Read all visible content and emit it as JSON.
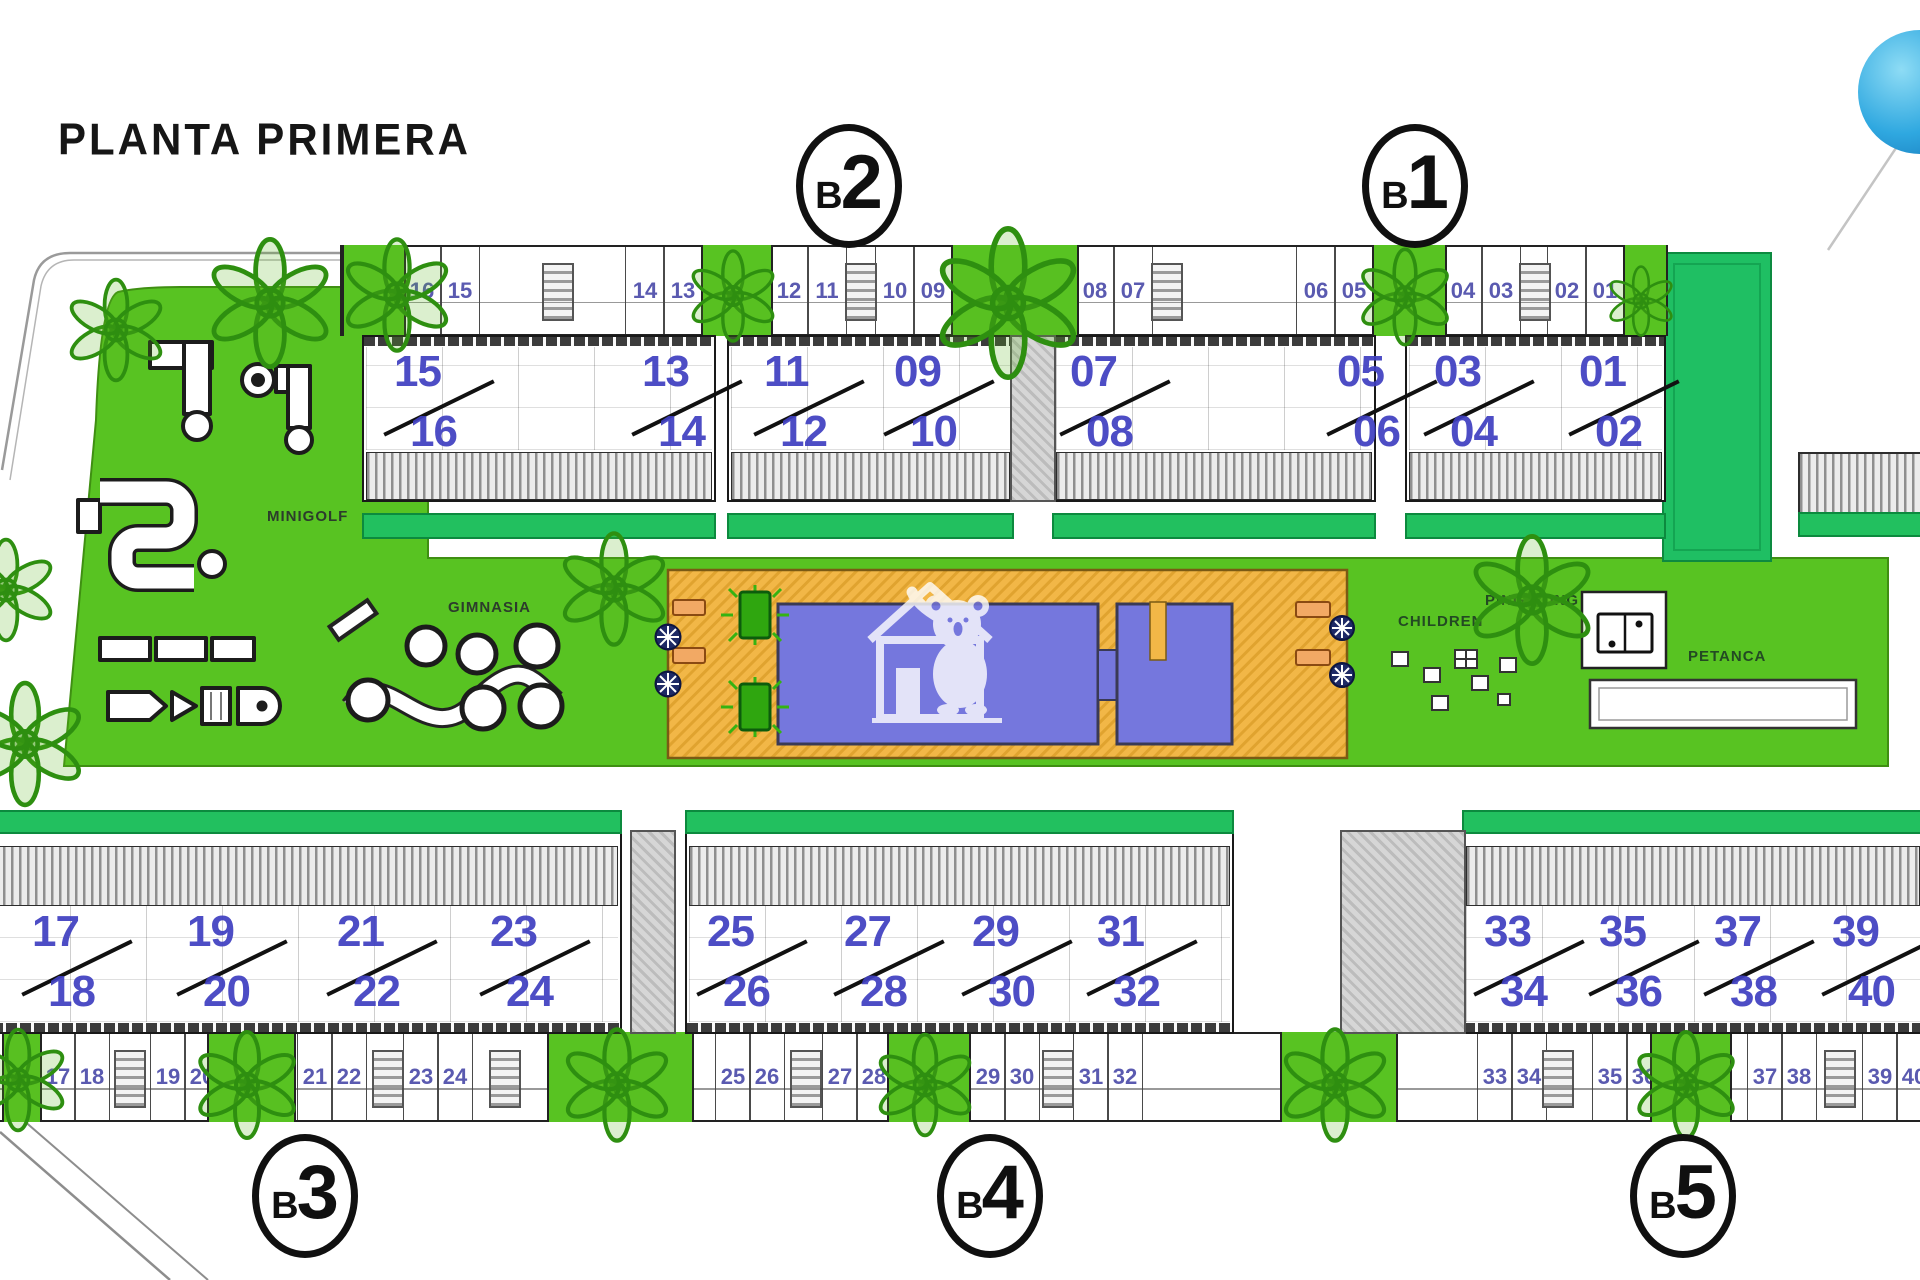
{
  "title": "PLANTA PRIMERA",
  "block_labels": [
    {
      "prefix": "B",
      "digit": "2"
    },
    {
      "prefix": "B",
      "digit": "1"
    },
    {
      "prefix": "B",
      "digit": "3"
    },
    {
      "prefix": "B",
      "digit": "4"
    },
    {
      "prefix": "B",
      "digit": "5"
    }
  ],
  "amenities": {
    "minigolf": "MINIGOLF",
    "gym": "GIMNASIA",
    "children": "CHILDREN",
    "ping_pong": "PING PONG",
    "petanca": "PETANCA"
  },
  "top_row": {
    "terrace_numbers": [
      [
        "16",
        "15"
      ],
      [
        "14",
        "13"
      ],
      [
        "12",
        "11"
      ],
      [
        "10",
        "09"
      ],
      [
        "08",
        "07"
      ],
      [
        "06",
        "05"
      ],
      [
        "04",
        "03"
      ],
      [
        "02",
        "01"
      ]
    ],
    "unit_pairs": [
      [
        "15",
        "16"
      ],
      [
        "13",
        "14"
      ],
      [
        "11",
        "12"
      ],
      [
        "09",
        "10"
      ],
      [
        "07",
        "08"
      ],
      [
        "05",
        "06"
      ],
      [
        "03",
        "04"
      ],
      [
        "01",
        "02"
      ]
    ]
  },
  "bottom_row": {
    "unit_pairs": [
      [
        "17",
        "18"
      ],
      [
        "19",
        "20"
      ],
      [
        "21",
        "22"
      ],
      [
        "23",
        "24"
      ],
      [
        "25",
        "26"
      ],
      [
        "27",
        "28"
      ],
      [
        "29",
        "30"
      ],
      [
        "31",
        "32"
      ],
      [
        "33",
        "34"
      ],
      [
        "35",
        "36"
      ],
      [
        "37",
        "38"
      ],
      [
        "39",
        "40"
      ]
    ],
    "terrace_numbers": [
      [
        "17",
        "18"
      ],
      [
        "19",
        "20"
      ],
      [
        "21",
        "22"
      ],
      [
        "23",
        "24"
      ],
      [
        "25",
        "26"
      ],
      [
        "27",
        "28"
      ],
      [
        "29",
        "30"
      ],
      [
        "31",
        "32"
      ],
      [
        "33",
        "34"
      ],
      [
        "35",
        "36"
      ],
      [
        "37",
        "38"
      ],
      [
        "39",
        "40"
      ]
    ]
  },
  "colors": {
    "lawn_green": "#58c322",
    "teal_green": "#22c05f",
    "deck_orange": "#f2b747",
    "pool_blue": "#7577dd",
    "unit_number_blue": "#4343c0",
    "terrace_number_blue": "#5a5ab0",
    "tree_green": "#2e8f10",
    "label_green": "#234a23",
    "logo_blue": "#2fa8e0"
  }
}
